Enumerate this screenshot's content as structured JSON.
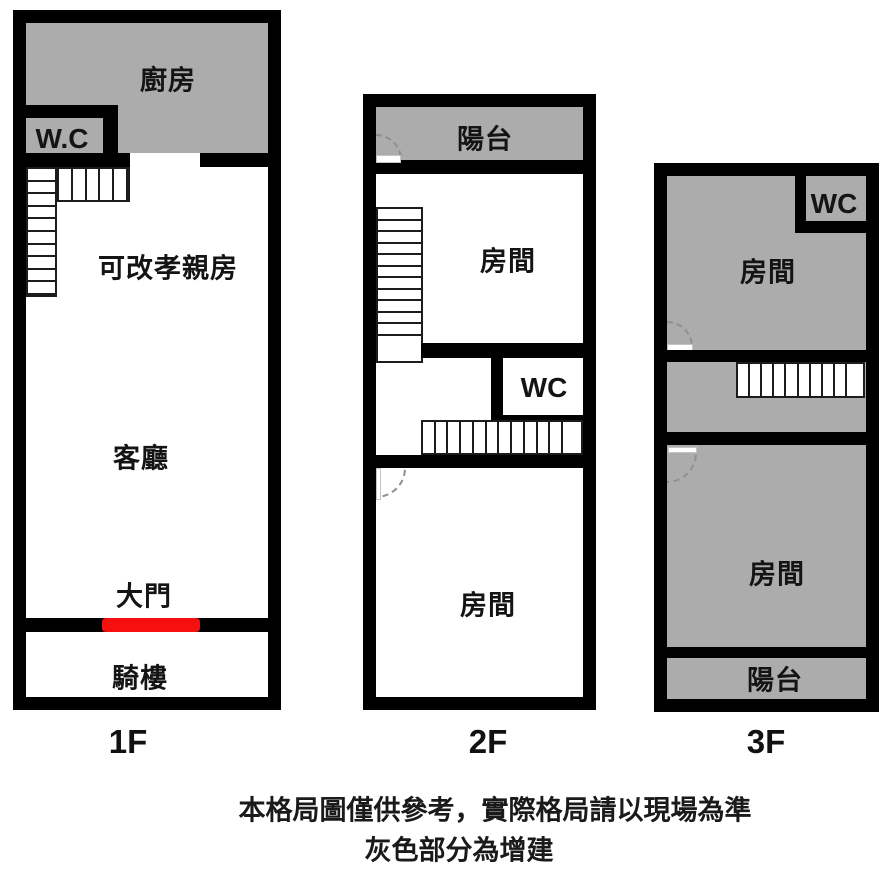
{
  "title": "3-floor townhouse floor plan",
  "colors": {
    "wall": "#000000",
    "addition_gray": "#acacac",
    "door_red": "#f50f0f"
  },
  "floors": [
    {
      "label": "1F",
      "rooms": {
        "kitchen": "廚房",
        "wc": "W.C",
        "parents_room": "可改孝親房",
        "living_room": "客廳",
        "main_door": "大門",
        "arcade": "騎樓"
      }
    },
    {
      "label": "2F",
      "rooms": {
        "balcony": "陽台",
        "room_top": "房間",
        "wc": "WC",
        "room_bottom": "房間"
      }
    },
    {
      "label": "3F",
      "rooms": {
        "wc": "WC",
        "room_top": "房間",
        "room_bottom": "房間",
        "balcony": "陽台"
      }
    }
  ],
  "caption": {
    "line1": "本格局圖僅供參考，實際格局請以現場為準",
    "line2": "灰色部分為增建"
  }
}
